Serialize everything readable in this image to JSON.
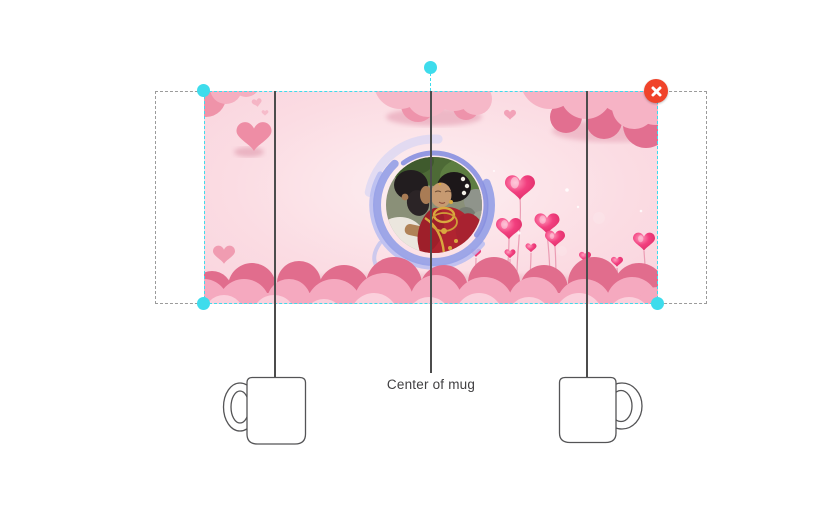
{
  "page": {
    "background_color": "#ffffff"
  },
  "editor": {
    "selection": {
      "handle_color": "#3edcec",
      "border_color": "#3edcec",
      "handles": [
        "top-left",
        "bottom-left",
        "bottom-right",
        "rotate"
      ]
    },
    "delete_button": {
      "icon": "close-icon",
      "color": "#f0432a"
    },
    "print_area": {
      "border_color": "#9b9b9b"
    },
    "guides": {
      "label": "Center of mug",
      "label_color": "#414042",
      "line_color": "#4c4c4c"
    },
    "mugs": {
      "outline_color": "#545456",
      "count": 2
    },
    "design": {
      "name": "wedding-couple-pink-hearts-mug-wrap-template",
      "background_color": "#fbdce3",
      "accent_colors": {
        "cloud_pink": "#f5abbf",
        "cloud_rose": "#e2708f",
        "heart_pink": "#ee8da5",
        "balloon_pink": "#f23f7f",
        "photo_ring_blue": "#97a0e6"
      }
    }
  }
}
